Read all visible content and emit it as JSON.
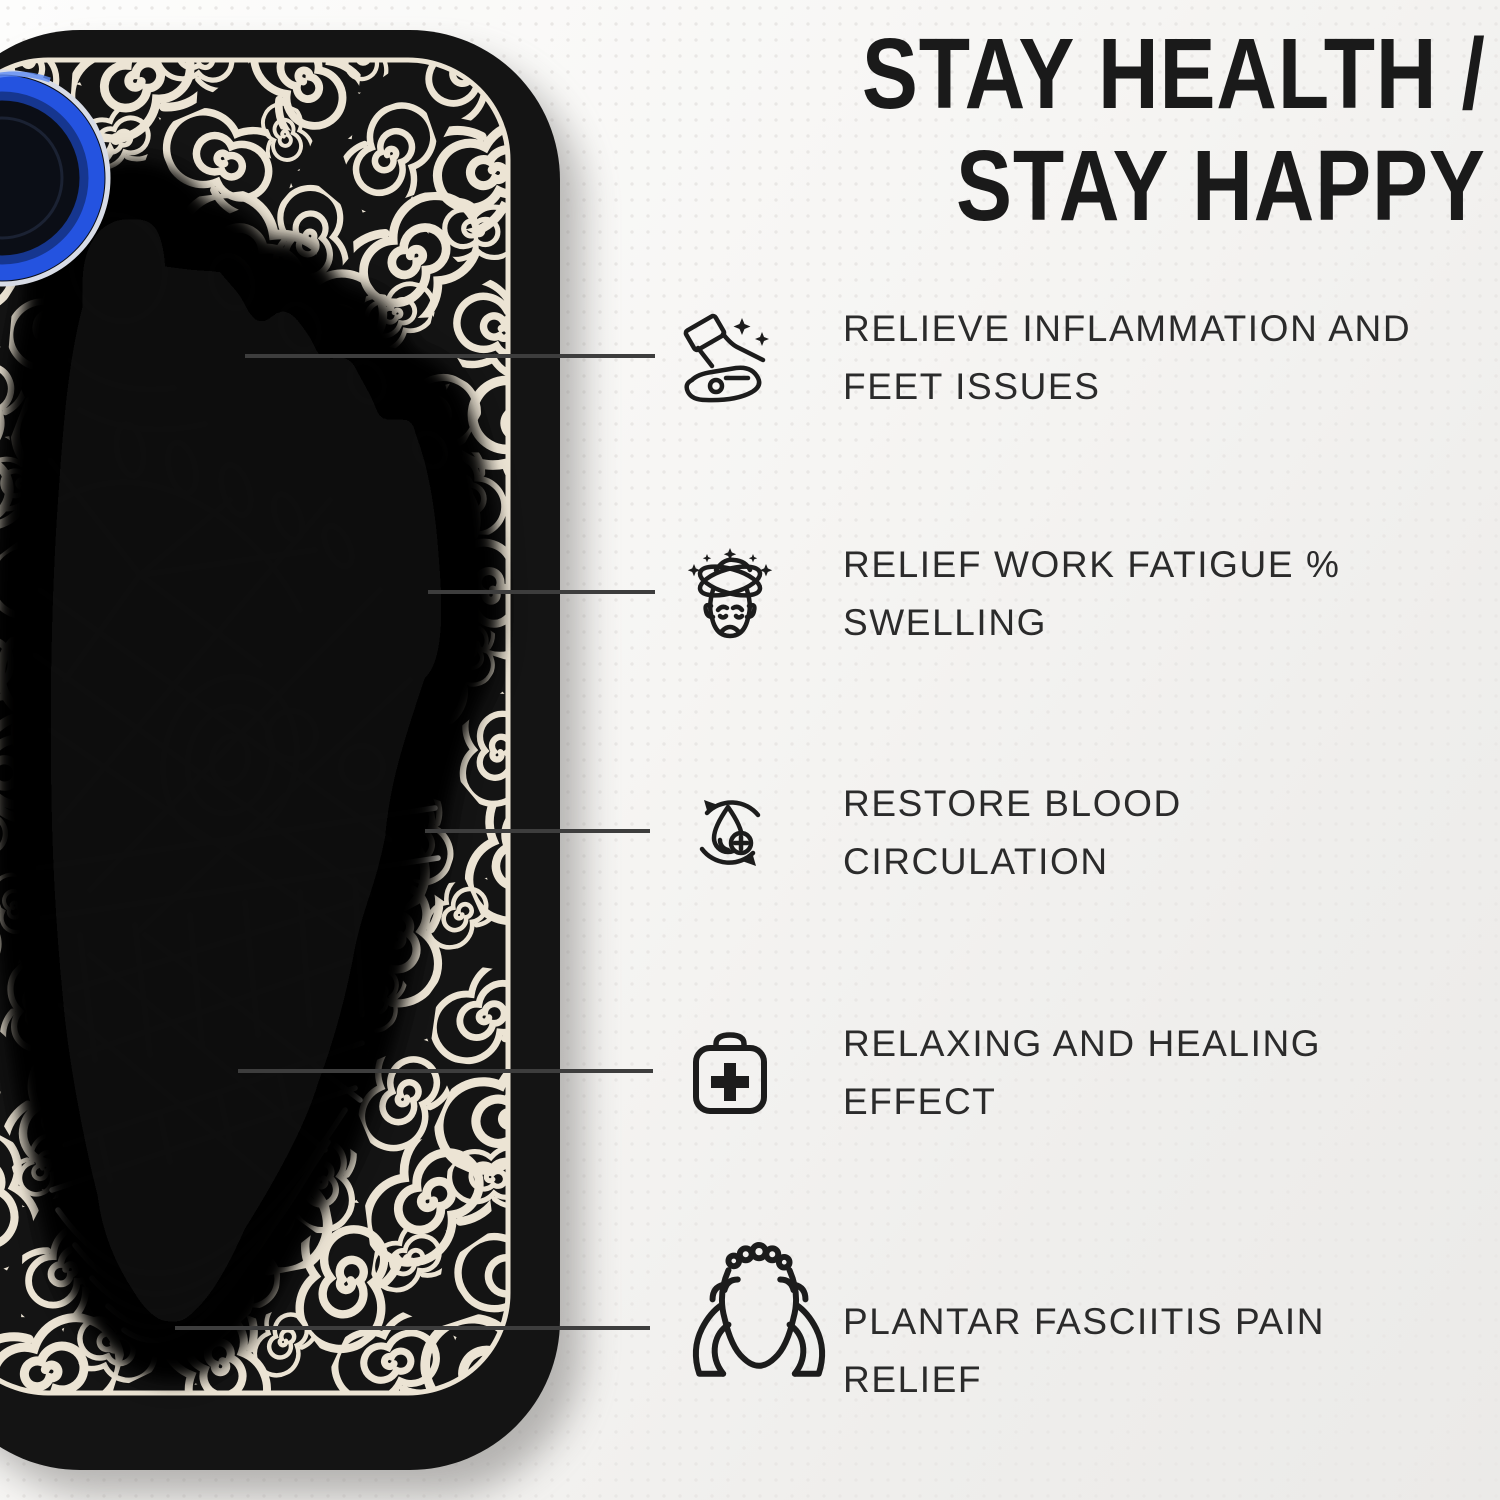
{
  "title": {
    "line1": "STAY HEALTH /",
    "line2": "STAY HAPPY"
  },
  "features": [
    {
      "icon": "foot-on-hand-sparkle-icon",
      "line1": "RELIEVE INFLAMMATION AND",
      "line2": "FEET ISSUES"
    },
    {
      "icon": "dizzy-face-icon",
      "line1": "RELIEF WORK FATIGUE %",
      "line2": "SWELLING"
    },
    {
      "icon": "blood-circulation-icon",
      "line1": "RESTORE BLOOD",
      "line2": "CIRCULATION"
    },
    {
      "icon": "first-aid-kit-icon",
      "line1": "RELAXING AND HEALING",
      "line2": "EFFECT"
    },
    {
      "icon": "foot-massage-hands-icon",
      "line1": "PLANTAR FASCIITIS PAIN",
      "line2": "RELIEF"
    }
  ],
  "colors": {
    "mat": "#141414",
    "swirl": "#ece4d4",
    "background": "#f4f3f1",
    "neon": "#8ed7f2",
    "device_ring": "#2453e0",
    "callout_line": "#3d3d3d",
    "text": "#2b2b2b",
    "title_text": "#1a1a1a"
  }
}
